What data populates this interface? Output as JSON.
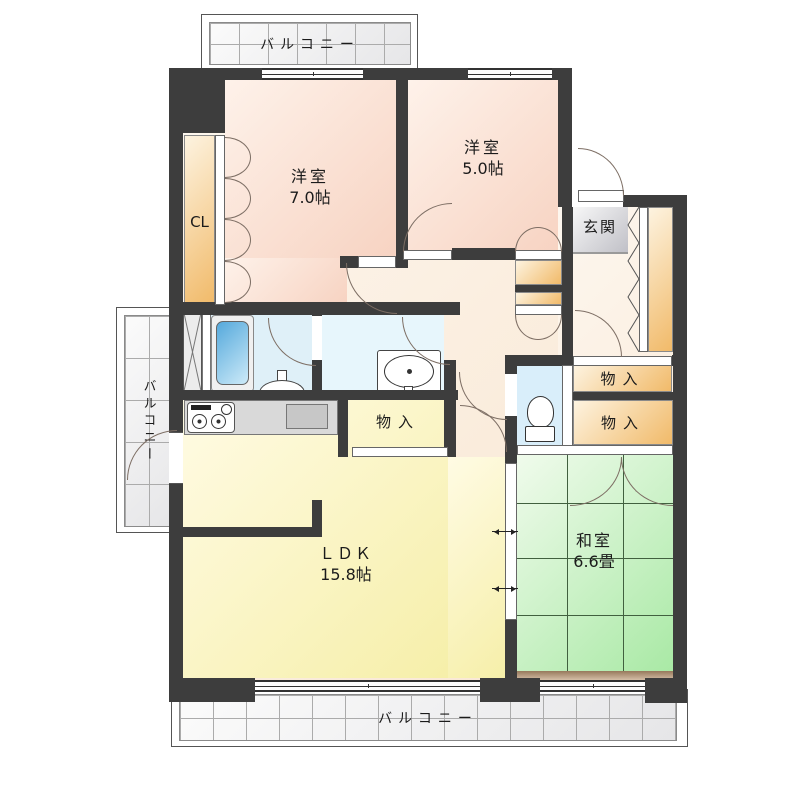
{
  "labels": {
    "balcony_top": "バルコニー",
    "balcony_left": "バルコニー",
    "balcony_bottom": "バルコニー",
    "bedroom1_name": "洋室",
    "bedroom1_size": "7.0帖",
    "bedroom2_name": "洋室",
    "bedroom2_size": "5.0帖",
    "closet": "CL",
    "entrance": "玄関",
    "storage_hall": "物入",
    "storage_right_upper": "物入",
    "storage_right_lower": "物入",
    "ldk_name": "ＬＤＫ",
    "ldk_size": "15.8帖",
    "japanese_room_name": "和室",
    "japanese_room_size": "6.6畳"
  },
  "colors": {
    "wall": "#3d3d3d",
    "bedroom_pink": "#f7d3c2",
    "ldk_yellow": "#f6efa9",
    "tatami_green": "#a9e9a5",
    "closet_orange": "#f1ba69",
    "entrance_gray": "#bfbfc6",
    "bath_blue": "#dff0f8",
    "tub_blue": "#58a9db"
  }
}
